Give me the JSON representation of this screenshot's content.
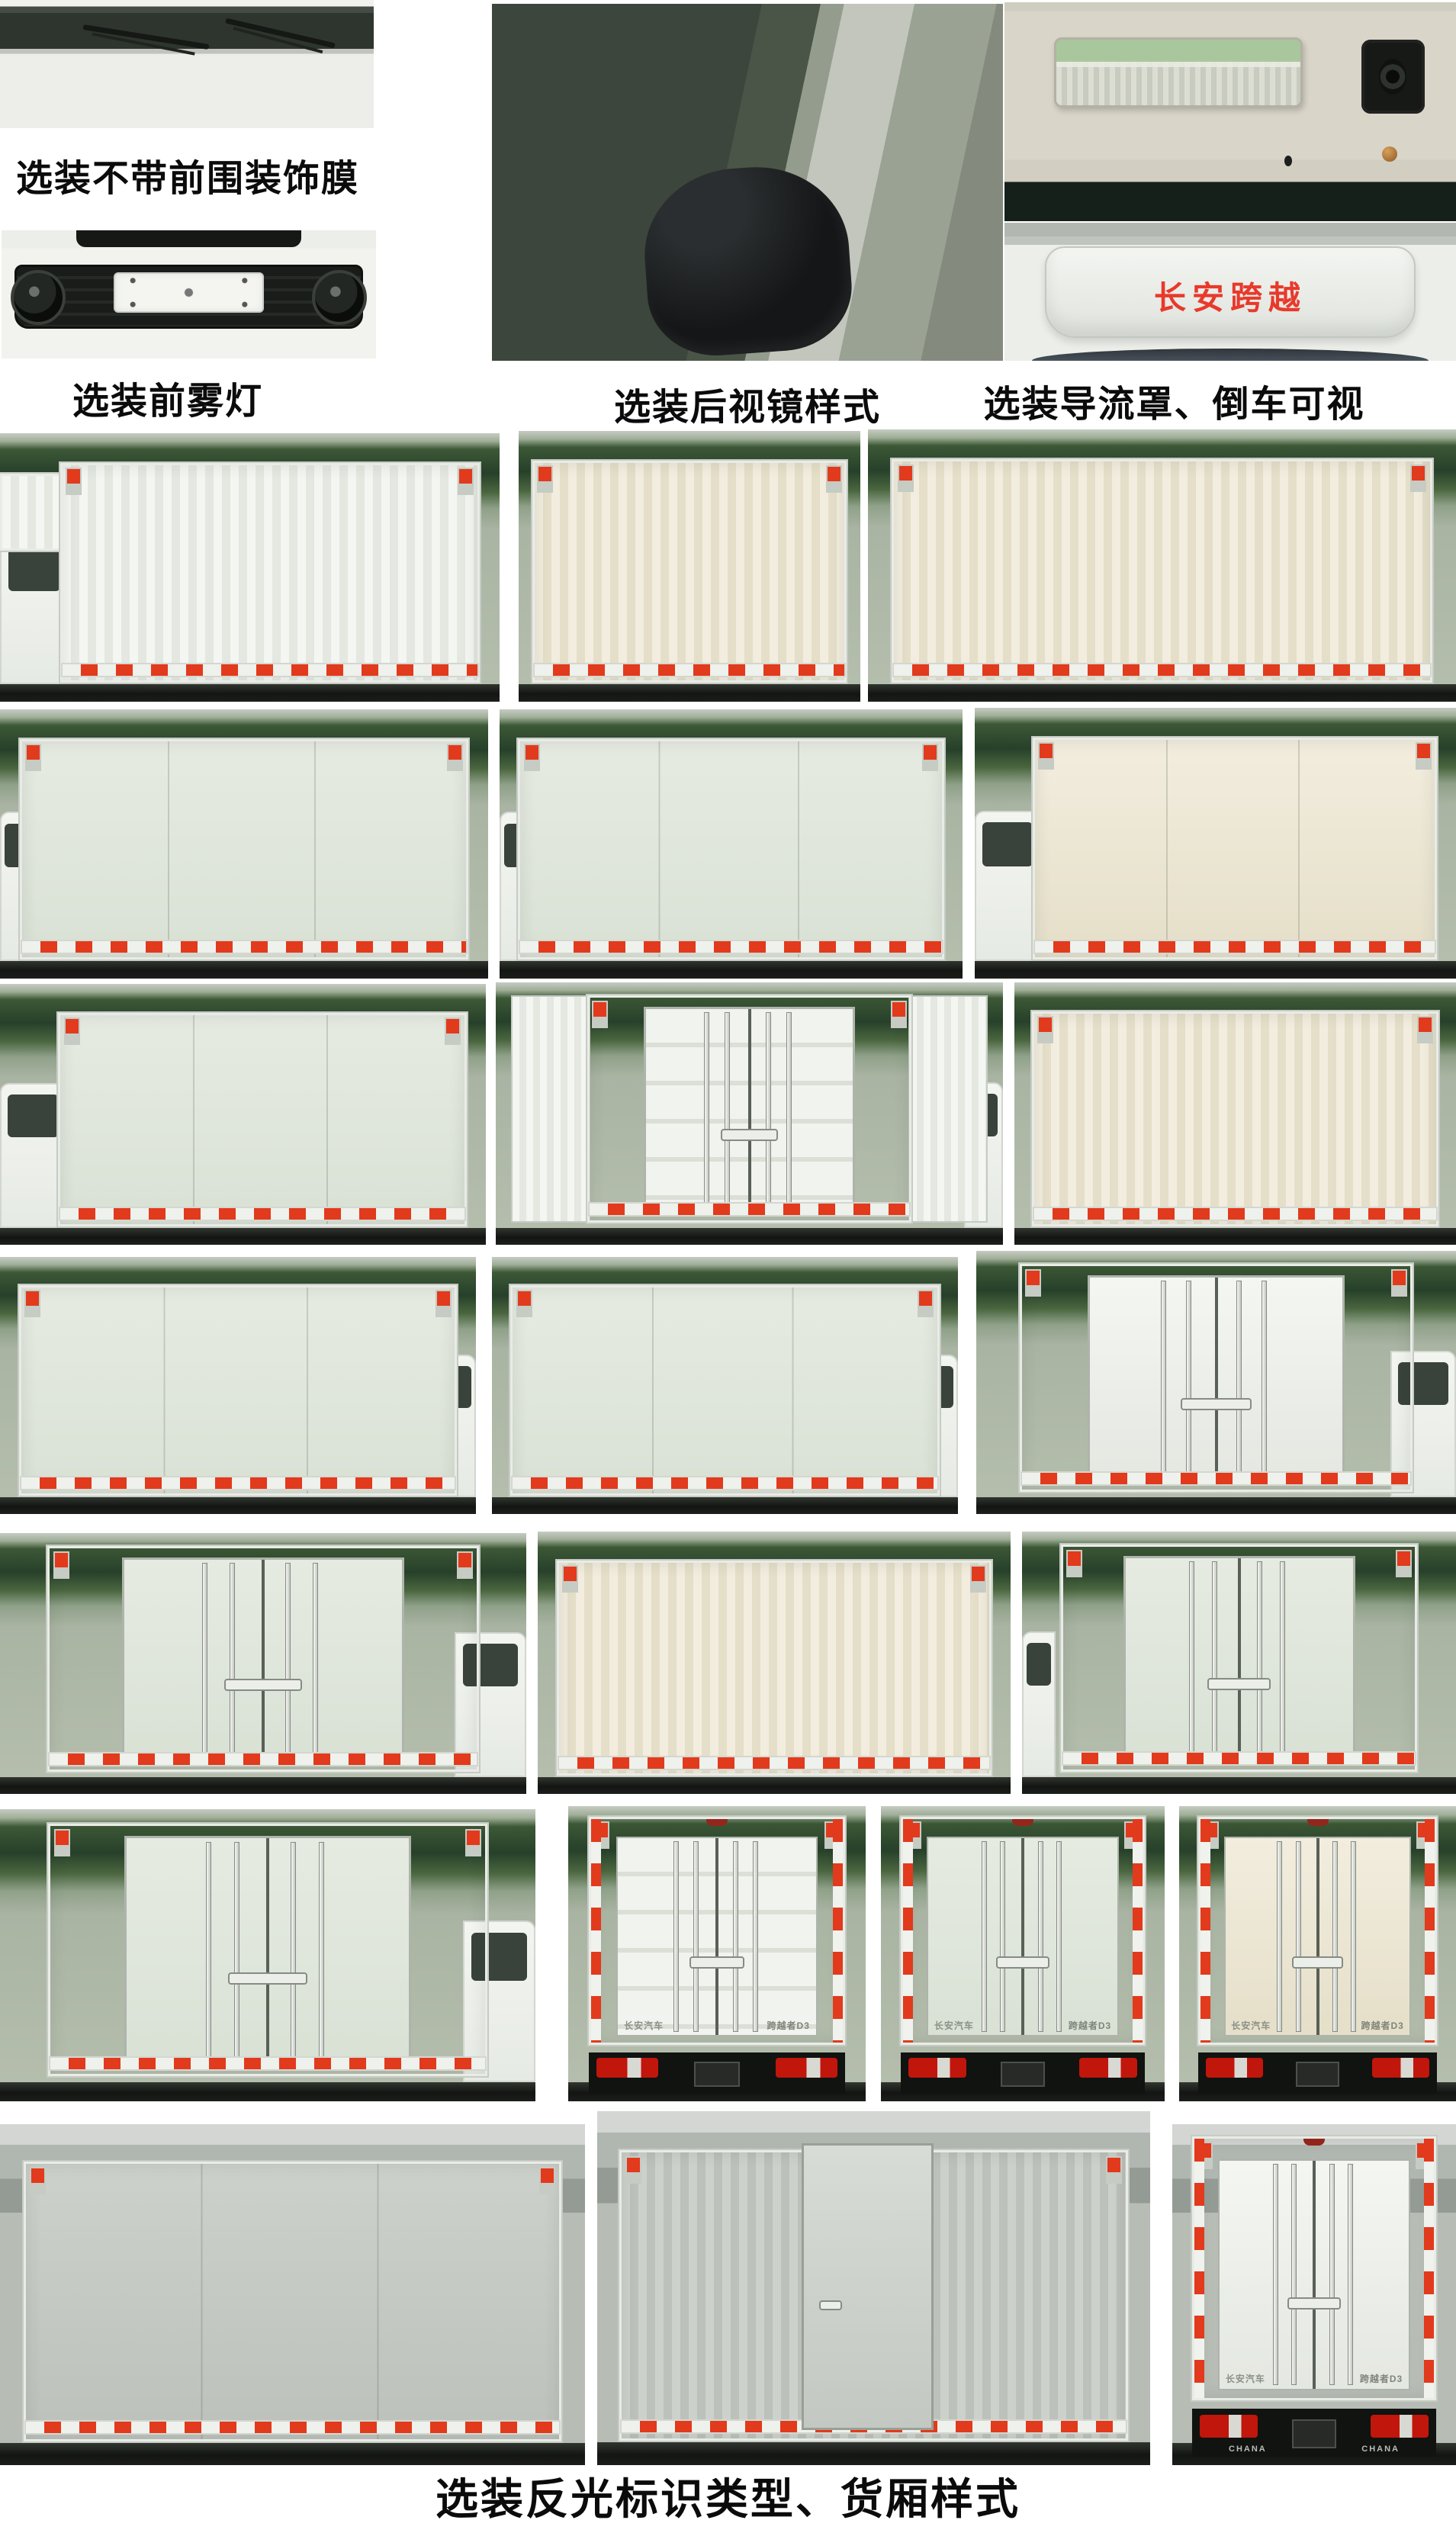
{
  "captions": {
    "option_no_front_trim_film": "选装不带前围装饰膜",
    "option_front_fog_lamps": "选装前雾灯",
    "option_mirror_style": "选装后视镜样式",
    "option_deflector_rear_camera": "选装导流罩、倒车可视",
    "option_reflective_marking_cargo_box": "选装反光标识类型、货厢样式"
  },
  "labels": {
    "deflector_logo": "长安跨越",
    "rear_brand": "长安汽车",
    "rear_model": "跨越者D3",
    "bumper_brand": "CHANA"
  },
  "theme": {
    "colors": {
      "reflective_red": "#e23a1c",
      "logo_red": "#e8392b",
      "taillight_red": "#c1160c",
      "lamp_green": "#a9c79c",
      "box_white": "#f4f6f2",
      "box_cream": "#f2edde",
      "box_sage": "#e6ebe2",
      "box_silver": "#cdd1cb",
      "foliage_green": "#2c452a",
      "chassis_black": "#171a17"
    }
  }
}
